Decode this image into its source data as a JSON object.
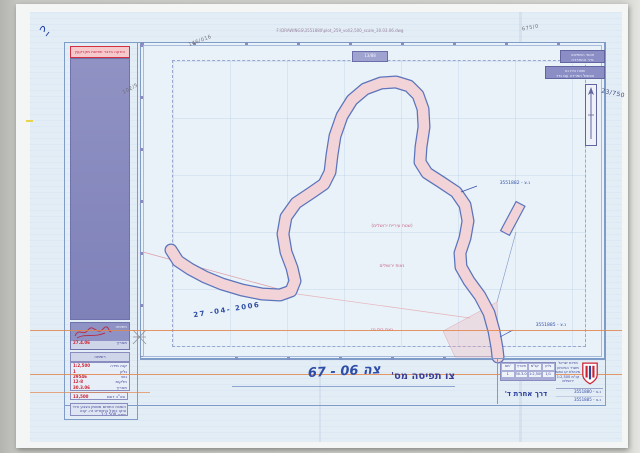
{
  "document": {
    "scan_path": "F:\\DRAWINGS\\3551880\\plot_259_vol\\2,500_scale_30.03.06.dwg",
    "sheet_box": "13/88"
  },
  "left_panel": {
    "header": "הודעה בדבר תפיסת מקרקעין",
    "signature": {
      "sign_label": "חתימה",
      "date_label": "תאריך",
      "date_value": "27.4.06"
    },
    "list_title": "רשימה",
    "rows": [
      {
        "label": "קנה מידה",
        "value": "1:2,500"
      },
      {
        "label": "גליון",
        "value": "1"
      },
      {
        "label": "גוש",
        "value": "29546"
      },
      {
        "label": "חלקות",
        "value": "12-8"
      },
      {
        "label": "תאריך",
        "value": "30.3.06"
      }
    ],
    "total_label": "סה\"כ דונם",
    "total_value": "13,500",
    "note": "השטח התפוס מסומן בצבע ורוד ובקו כחול בתשריט זה. קנה מידה 1:2,500."
  },
  "map": {
    "legend": [
      {
        "line1": "תוואי התפיסה",
        "line2": "גדר ההפרדה"
      },
      {
        "line1": "שטח בית גוז",
        "line2": "מכשול הפרדה עם גדר"
      }
    ],
    "labels": {
      "area_a": "(שטח עיריית ירושלים)",
      "area_b": "נאות ירושלים",
      "area_c": "נאת בית גוז",
      "coord_top": "נ.צ - 3551882",
      "coord_bottom": "נ.צ - 3551885"
    },
    "pencil": {
      "top": "146/016",
      "left": "102/5",
      "top_right": "675/0",
      "right": "23/750"
    },
    "date_stamp": "27 -04- 2006"
  },
  "title_block": {
    "order_label": "צו תפיסה מס'",
    "order_number": "צה 06 - 67",
    "road_name": "דרך אחרת ד'",
    "org_lines": [
      "מדינת ישראל",
      "משרד הביטחון",
      "מינהלת קו התפר",
      "קנ\"מ 1:2,500",
      "ירושלים"
    ],
    "coords": [
      "נ.צ - 3551880",
      "נ.צ - 3551885"
    ],
    "table": {
      "headers": [
        "מס'",
        "תאריך",
        "קנ\"מ",
        "גליון"
      ],
      "row": [
        "1",
        "30.3.06",
        "1:2,500",
        "1/1"
      ]
    }
  }
}
